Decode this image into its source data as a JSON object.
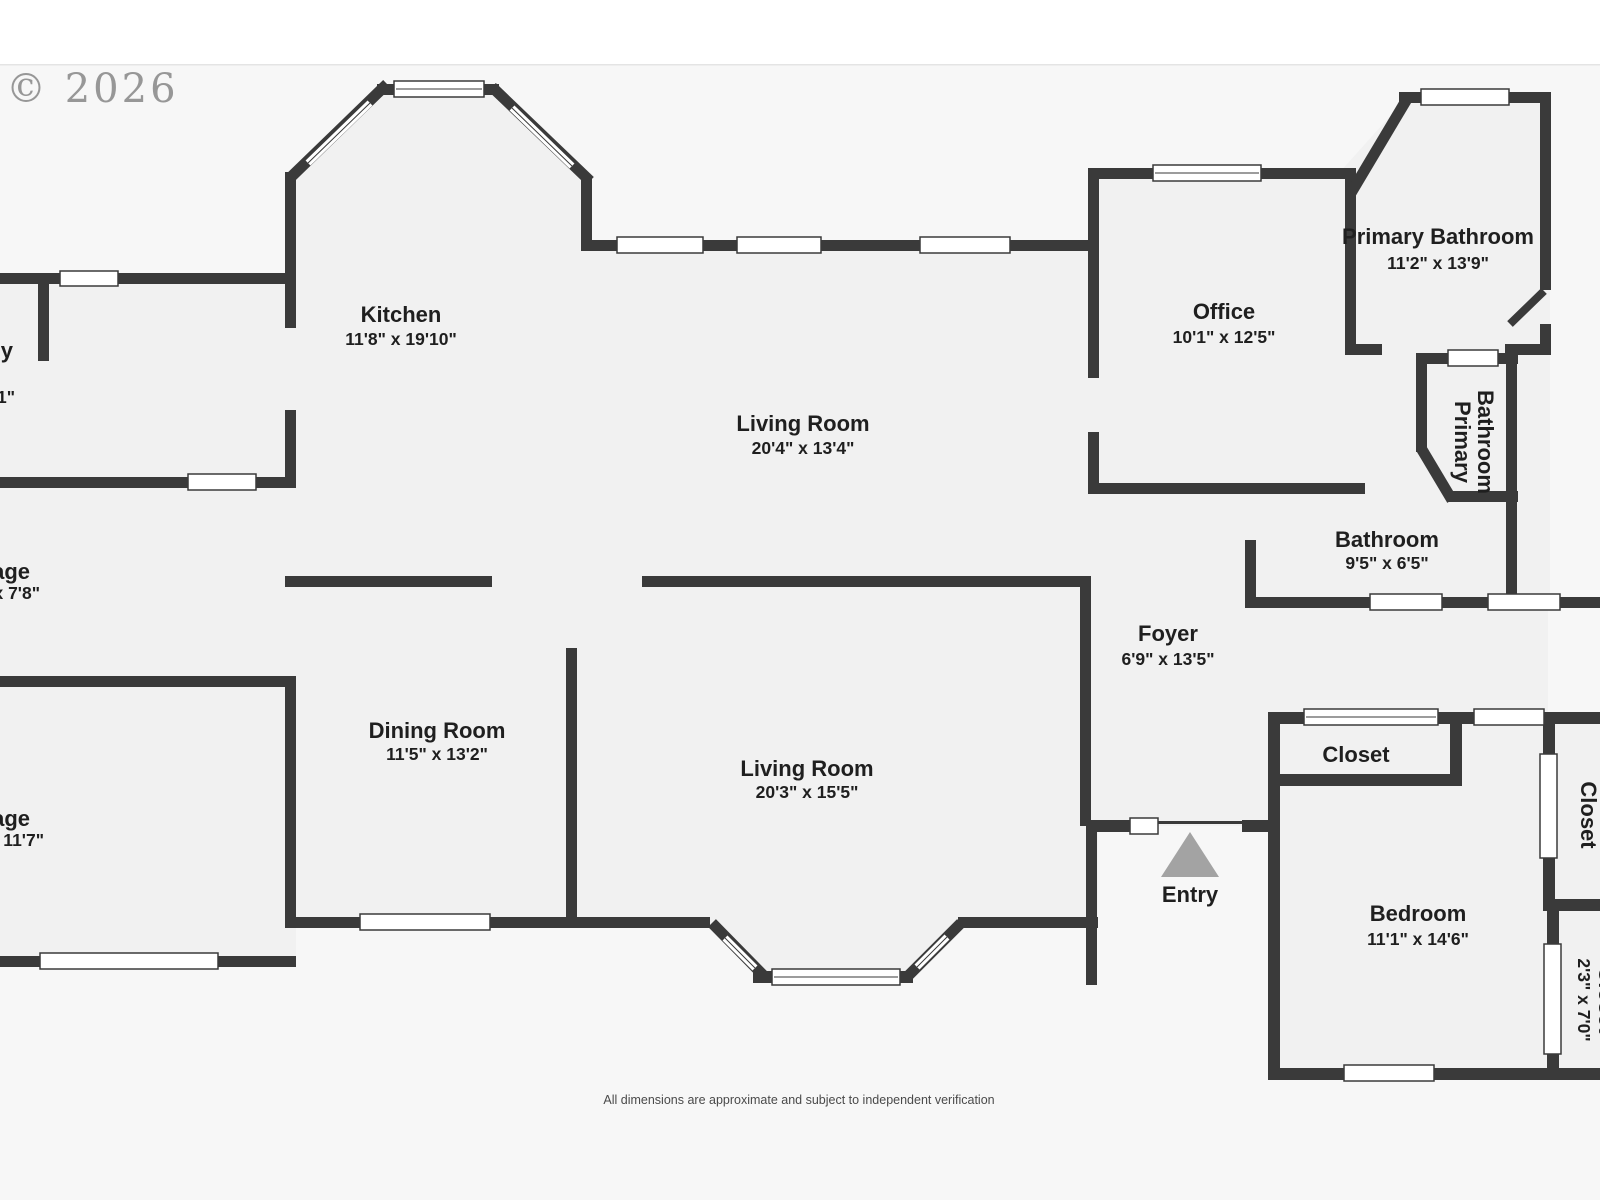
{
  "watermark": "© 2026",
  "disclaimer": "All dimensions are approximate and subject to independent verification",
  "rooms": {
    "kitchen": {
      "name": "Kitchen",
      "dims": "11'8\" x 19'10\""
    },
    "living_room_upper": {
      "name": "Living Room",
      "dims": "20'4\" x 13'4\""
    },
    "office": {
      "name": "Office",
      "dims": "10'1\" x 12'5\""
    },
    "primary_bathroom": {
      "name": "Primary Bathroom",
      "dims": "11'2\" x 13'9\""
    },
    "primary_bathroom_small": {
      "name_line1": "Primary",
      "name_line2": "Bathroom"
    },
    "bathroom": {
      "name": "Bathroom",
      "dims": "9'5\" x 6'5\""
    },
    "foyer": {
      "name": "Foyer",
      "dims": "6'9\" x 13'5\""
    },
    "dining_room": {
      "name": "Dining Room",
      "dims": "11'5\" x 13'2\""
    },
    "living_room_lower": {
      "name": "Living Room",
      "dims": "20'3\" x 15'5\""
    },
    "entry": {
      "name": "Entry"
    },
    "closet_bedroom": {
      "name": "Closet"
    },
    "bedroom": {
      "name": "Bedroom",
      "dims": "11'1\" x 14'6\""
    },
    "closet_right_upper": {
      "name": "Closet",
      "dims": "2'3\" x 7'1\""
    },
    "closet_right_lower": {
      "name": "Closet",
      "dims": "2'3\" x 7'0\""
    },
    "room_left_top": {
      "name_fragment": "y",
      "dims_fragment": "1\""
    },
    "room_left_middle": {
      "name_fragment": "age",
      "dims_fragment": "x 7'8\""
    },
    "room_left_bottom": {
      "name_fragment": "age",
      "dims_fragment": "x 11'7\""
    }
  },
  "colors": {
    "wall": "#3a3a3a",
    "floor": "#f1f1f1",
    "background": "#f7f7f7",
    "window": "#ffffff",
    "entry_arrow": "#a3a3a3",
    "text": "#1f1f1f",
    "watermark": "#8a8a8a"
  }
}
